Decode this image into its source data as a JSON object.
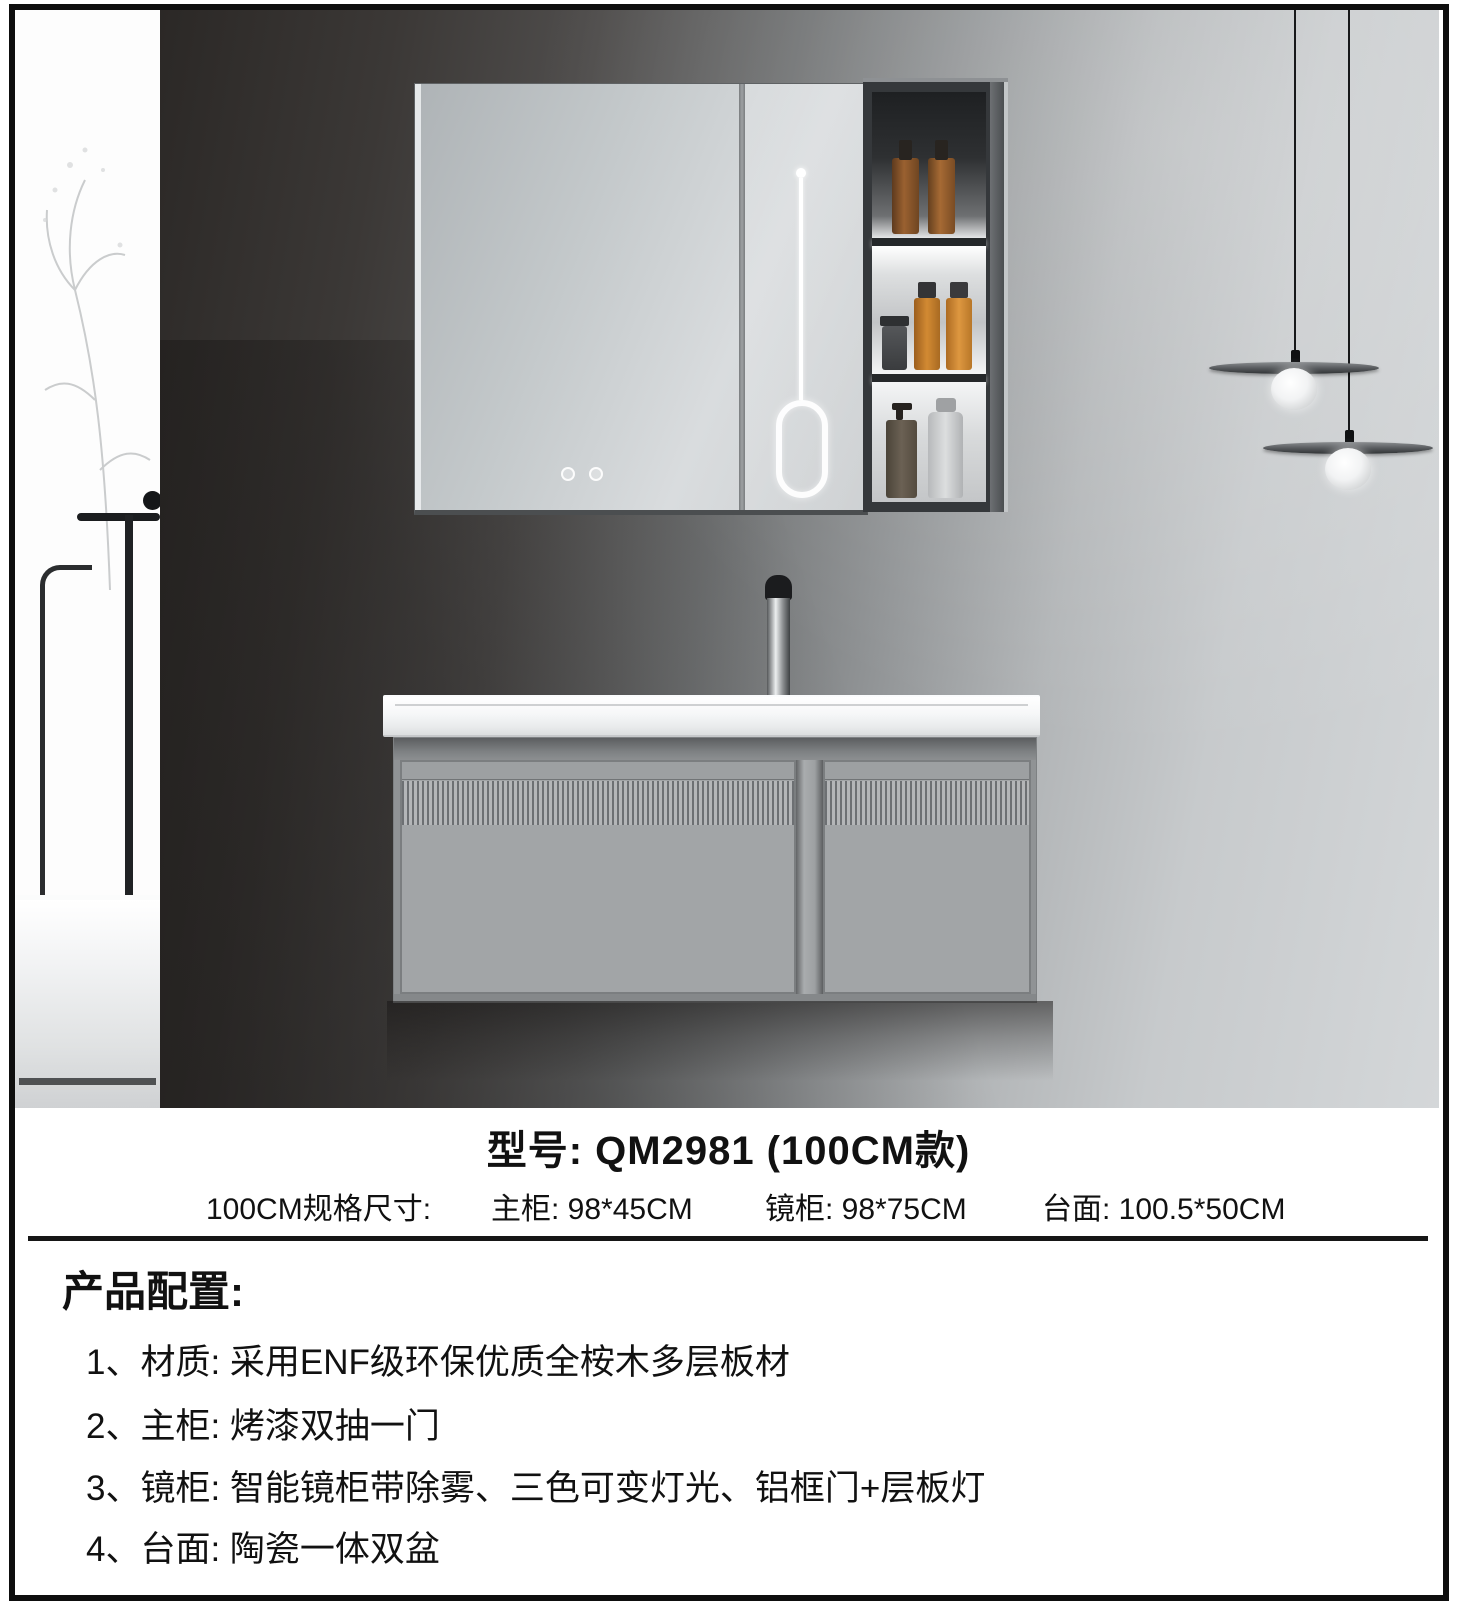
{
  "product": {
    "model_label": "型号: QM2981 (100CM款)",
    "size_row": {
      "label": "100CM规格尺寸:",
      "main_cabinet": "主柜: 98*45CM",
      "mirror_cabinet": "镜柜: 98*75CM",
      "countertop": "台面: 100.5*50CM"
    },
    "config": {
      "title": "产品配置:",
      "items": [
        "1、材质: 采用ENF级环保优质全桉木多层板材",
        "2、主柜: 烤漆双抽一门",
        "3、镜柜: 智能镜柜带除雾、三色可变灯光、铝框门+层板灯",
        "4、台面: 陶瓷一体双盆"
      ]
    }
  },
  "scene": {
    "colors": {
      "frame_border": "#0e0e0e",
      "wall_dark": "#2b2826",
      "wall_light": "#d4d7d9",
      "mirror_surface": "#cdd2d4",
      "shelf_frame": "#35383b",
      "bottle_amber": "#a66a34",
      "bottle_orange": "#d28a33",
      "led_light": "#ffffff",
      "pendant_shade": "#303335",
      "countertop_white": "#f6f7f8",
      "vanity_gray": "#a2a5a7",
      "text_black": "#111111"
    }
  }
}
